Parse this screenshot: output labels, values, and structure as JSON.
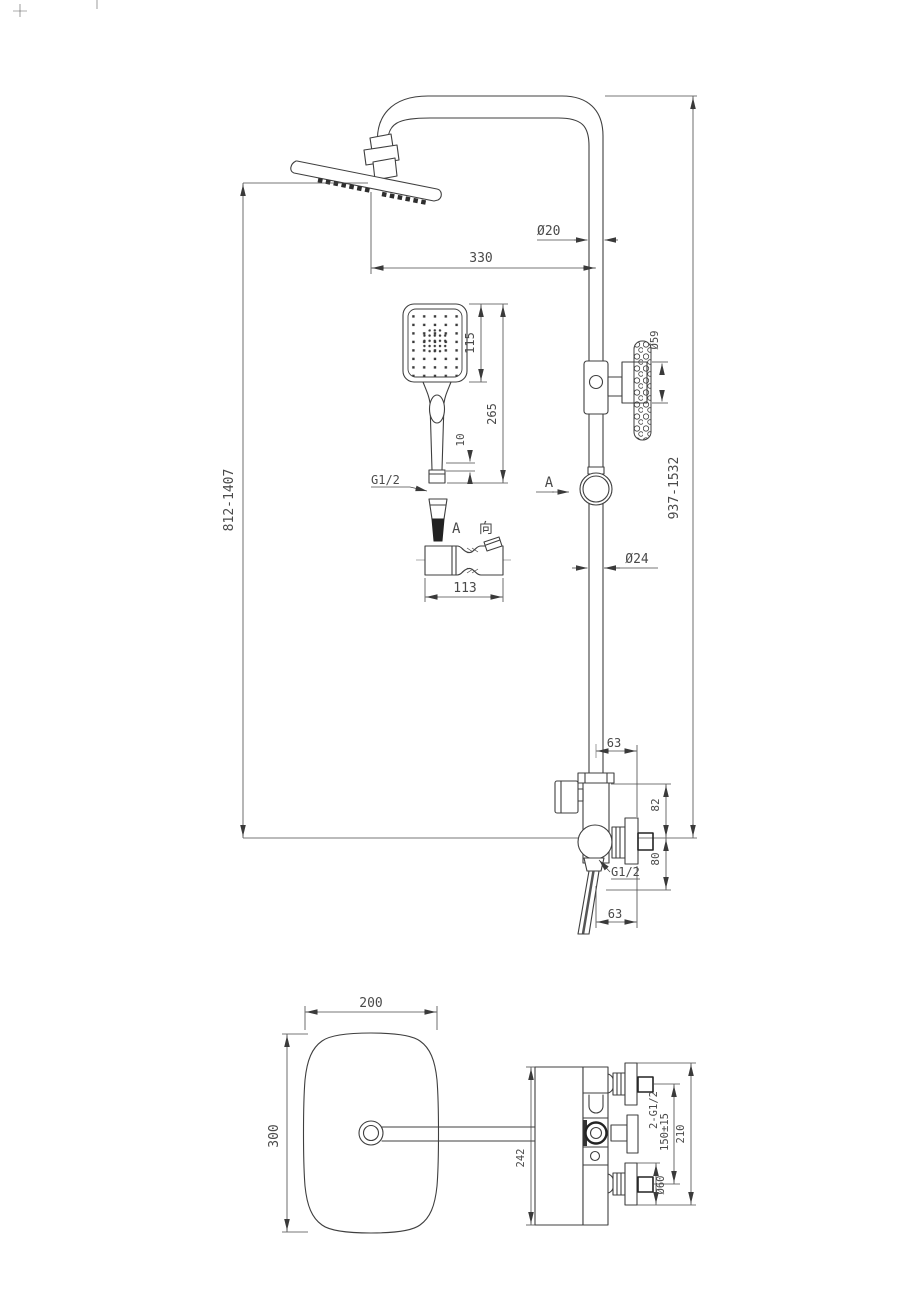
{
  "drawing": {
    "front": {
      "pipe_dia_top": "Ø20",
      "arm_reach": "330",
      "hand_head_len": "115",
      "hand_total_len": "265",
      "hand_nut_len": "10",
      "hand_thread": "G1/2",
      "knob_dia": "Ø59",
      "left_height_range": "812-1407",
      "right_height_range": "937-1532",
      "view_label": "A",
      "pipe_dia_bottom": "Ø24",
      "detail_title": "A 向",
      "detail_width": "113",
      "top_offset": "63",
      "upper_height": "82",
      "lower_height": "80",
      "outlet_thread": "G1/2",
      "bottom_offset": "63"
    },
    "plan": {
      "head_width": "200",
      "head_depth": "300",
      "body_span": "242",
      "inlet_note": "2-G1/2",
      "inlet_spacing": "150±15",
      "overall_span": "210",
      "flange_dia": "Ø60"
    }
  }
}
